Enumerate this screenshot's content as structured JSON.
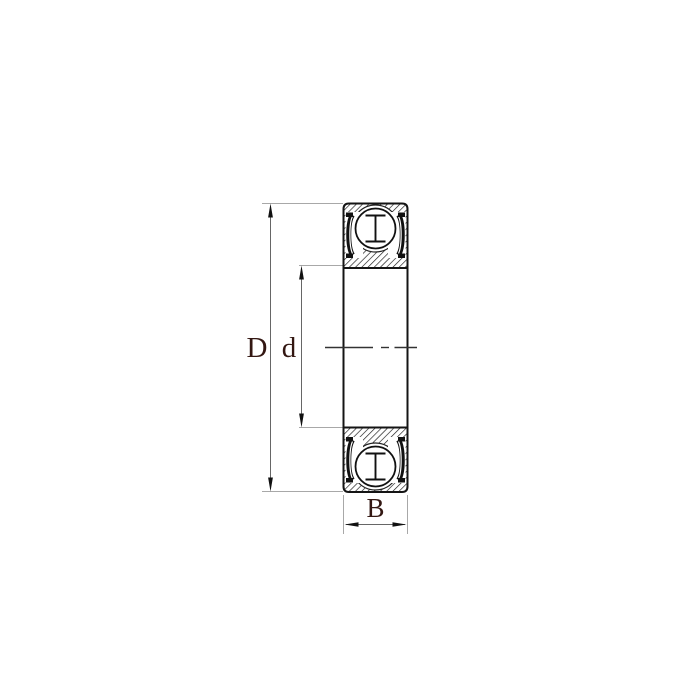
{
  "diagram": {
    "kind": "deep-groove-ball-bearing-cross-section",
    "dimension_labels": {
      "outer_diameter": "D",
      "bore_diameter": "d",
      "width": "B"
    },
    "parts": [
      "outer-ring-section",
      "inner-ring-section",
      "ball-rolling-element",
      "cage-symbol",
      "rubber-seal",
      "bore-centerline"
    ],
    "colors": {
      "background": "#ffffff",
      "outline": "#141414",
      "hatch": "#161616",
      "dimension_line": "#666666",
      "extension_line": "#a8a8a8",
      "centerline": "#333333",
      "label_text": "#331712"
    }
  }
}
